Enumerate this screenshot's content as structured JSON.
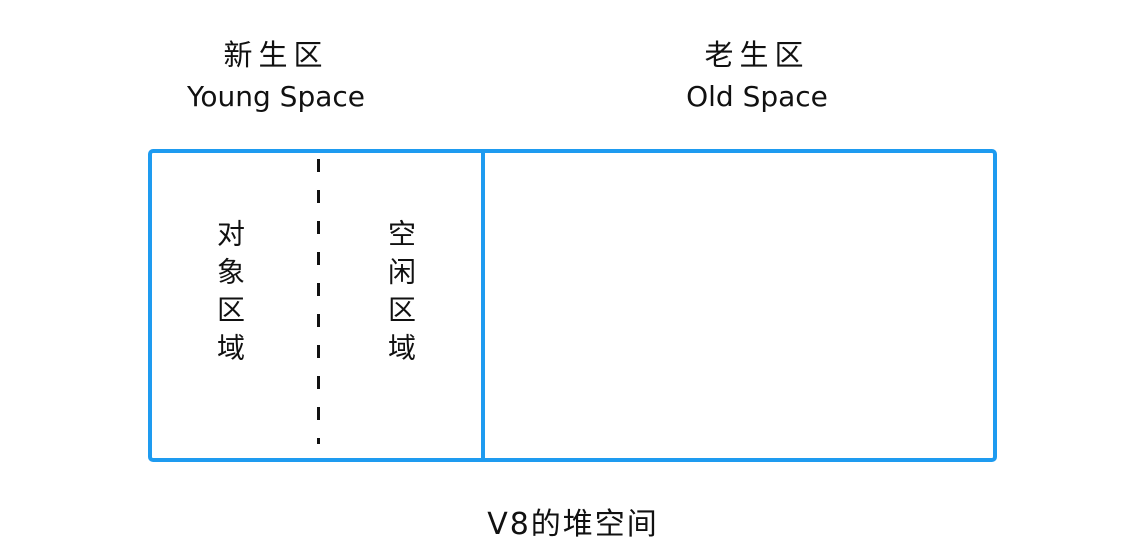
{
  "diagram": {
    "young_space": {
      "title_zh": "新生区",
      "title_en": "Young Space",
      "object_area_label": "对象区域",
      "free_area_label": "空闲区域"
    },
    "old_space": {
      "title_zh": "老生区",
      "title_en": "Old Space"
    },
    "caption": "V8的堆空间",
    "colors": {
      "box_border": "#1e9bf0",
      "divider_dashed": "#111111",
      "text": "#111111",
      "background": "#ffffff"
    }
  }
}
